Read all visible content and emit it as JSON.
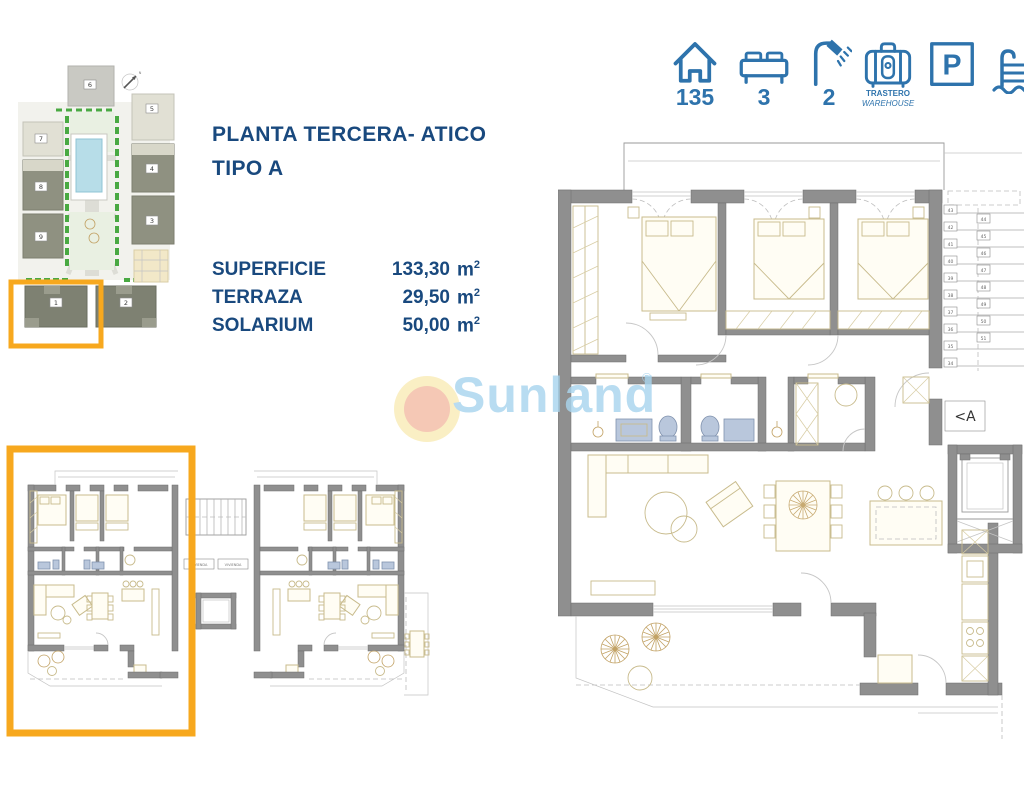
{
  "header": {
    "accent": "#2E73AC",
    "icons": {
      "house": {
        "value": "135"
      },
      "bed": {
        "value": "3"
      },
      "shower": {
        "value": "2"
      },
      "storage": {
        "line1": "TRASTERO",
        "line2": "WAREHOUSE"
      },
      "parking": {
        "letter": "P"
      }
    }
  },
  "title": {
    "line1": "PLANTA TERCERA- ATICO",
    "line2": "TIPO A"
  },
  "surfaces": {
    "rows": [
      {
        "label": "SUPERFICIE",
        "value": "133,30",
        "unit": "m",
        "sup": "2"
      },
      {
        "label": "TERRAZA",
        "value": "29,50",
        "unit": "m",
        "sup": "2"
      },
      {
        "label": "SOLARIUM",
        "value": "50,00",
        "unit": "m",
        "sup": "2"
      }
    ]
  },
  "watermark": {
    "brand": "Sunland",
    "reg": "®"
  },
  "site_plan": {
    "compass": "N",
    "buildings": {
      "b1": "1",
      "b2": "2",
      "b3": "3",
      "b4": "4",
      "b5": "5",
      "b6": "6",
      "b7": "7",
      "b8": "8",
      "b9": "9"
    }
  },
  "main_plan": {
    "entry_label": "<A",
    "stairs_left": [
      "43",
      "42",
      "41",
      "40",
      "39",
      "38",
      "37",
      "36",
      "35",
      "34"
    ],
    "stairs_right": [
      "44",
      "45",
      "46",
      "47",
      "48",
      "49",
      "50",
      "51"
    ]
  },
  "small_plan": {
    "left_unit_label": "VIVIENDA",
    "right_unit_label": "VIVIENDA"
  },
  "colors": {
    "highlight": "#F7A81E",
    "navy": "#19497E",
    "icon_blue": "#2E73AC"
  }
}
